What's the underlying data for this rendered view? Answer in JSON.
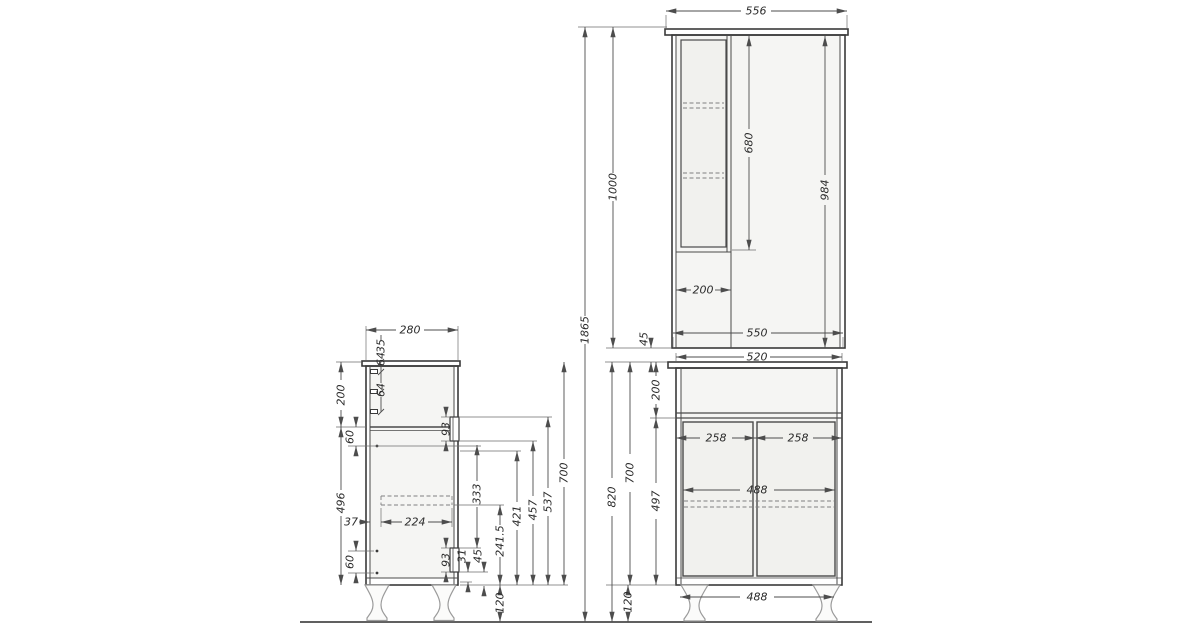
{
  "dims": {
    "overall": {
      "total_height": "1865",
      "upper_height": "1000",
      "wall_gap": "45",
      "lower_total_height": "820",
      "lower_body_height": "700",
      "leg_height": "120"
    },
    "upper_front": {
      "top_width": "556",
      "door_height": "680",
      "body_height": "984",
      "shelf_width": "200",
      "bottom_width": "550"
    },
    "side": {
      "depth": "280",
      "hinge_offset_top": "35",
      "hinge_gap_upper": "64",
      "hinge_gap_lower": "64",
      "drawer_section": "200",
      "below_drawer_offset": "60",
      "door_section": "496",
      "shelf_back_gap": "37",
      "shelf_depth": "224",
      "above_bottom_offset": "60",
      "drawer_handle": "93",
      "door_handle": "93",
      "handle_bottom_offset": "31",
      "handle_clearance": "45",
      "shelf_height": "241.5",
      "leg_height": "120",
      "height_a": "333",
      "height_b": "421",
      "height_c": "457",
      "height_d": "537",
      "body_height": "700"
    },
    "lower_front": {
      "top_width": "520",
      "drawer_section": "200",
      "door_section": "497",
      "left_door_width": "258",
      "right_door_width": "258",
      "inner_width": "488",
      "leg_span": "488"
    }
  }
}
